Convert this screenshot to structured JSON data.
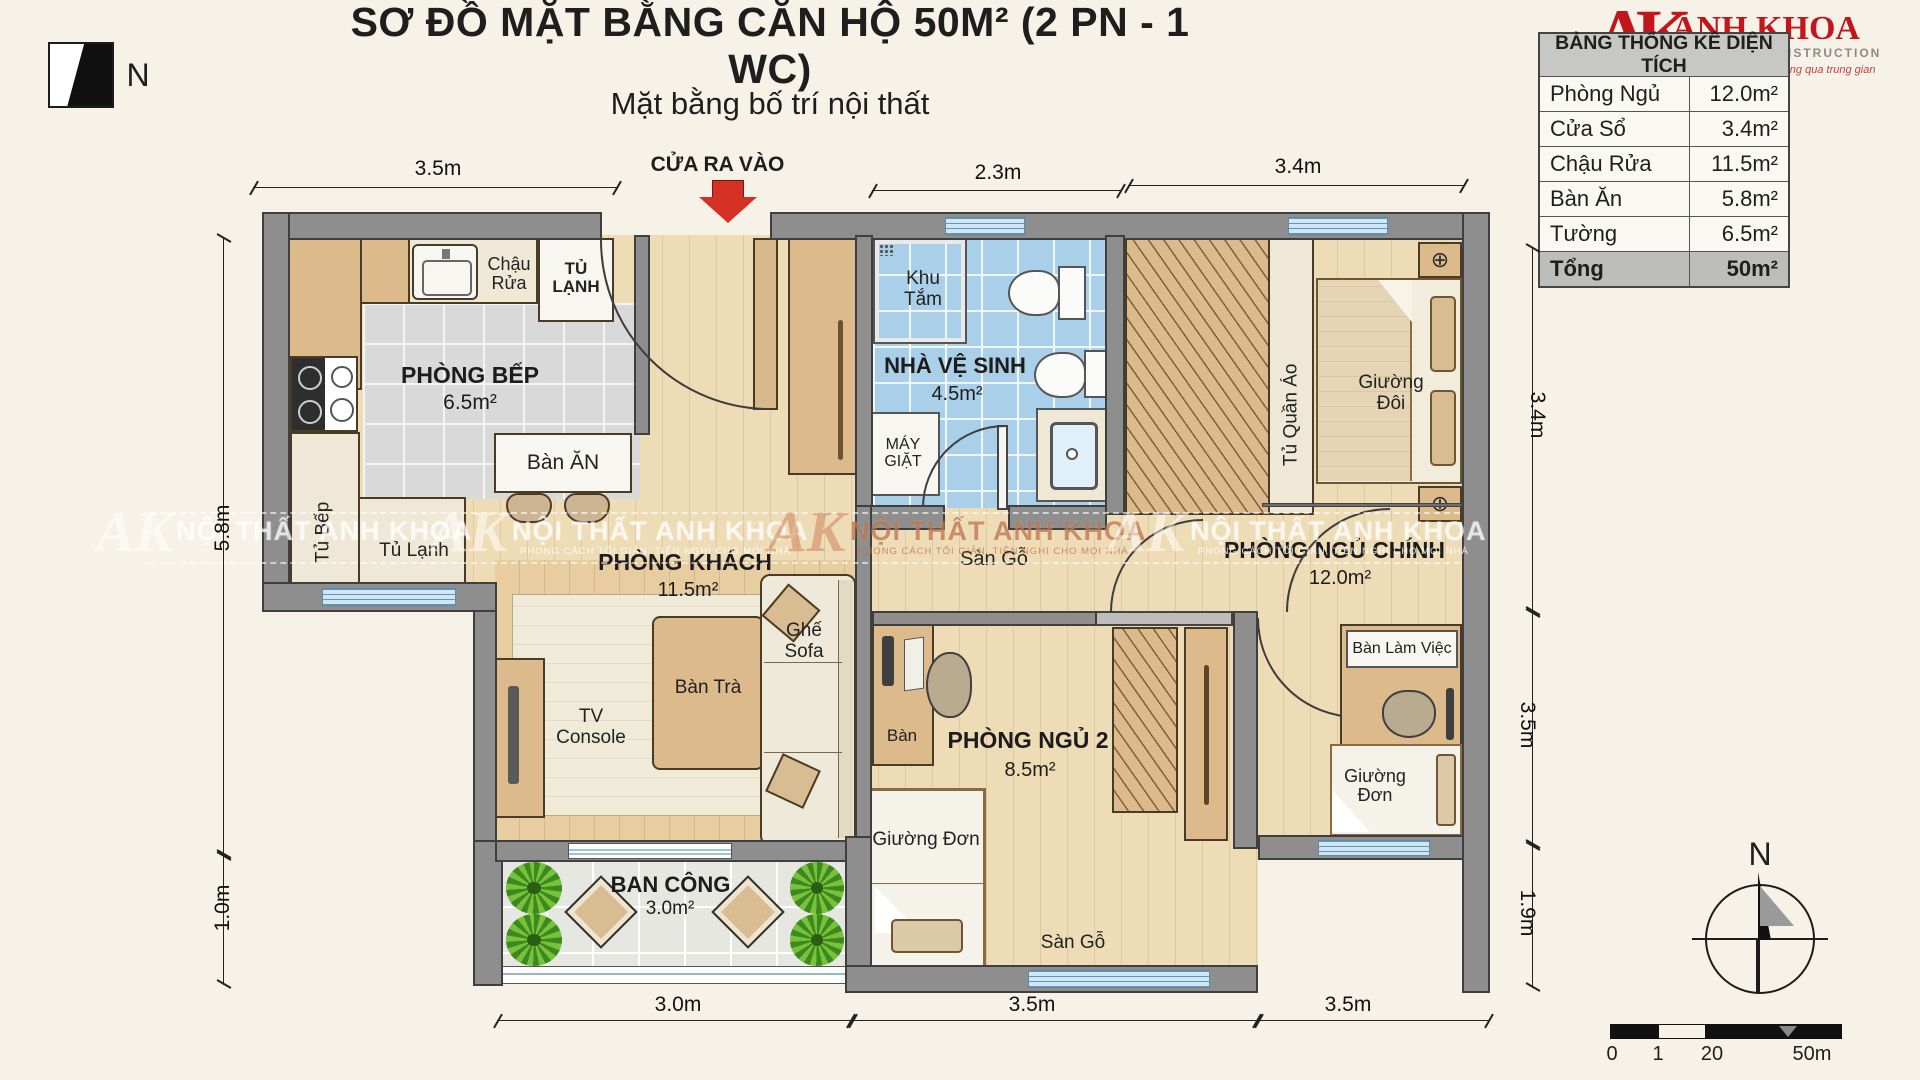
{
  "header": {
    "title": "SƠ ĐỒ MẶT BẰNG CĂN HỘ 50M² (2 PN - 1 WC)",
    "subtitle": "Mặt bằng bố trí nội thất",
    "entrance_label": "CỬA RA VÀO"
  },
  "logo": {
    "monogram": "AK",
    "name": "ANH KHOA",
    "tagline1": "INTERIOR CONSTRUCTION",
    "tagline2": "Sản xuất trực tiếp - Không qua trung gian"
  },
  "area_table": {
    "header": "BẢNG THỐNG KÊ DIỆN TÍCH",
    "rows": [
      {
        "label": "Phòng Ngủ",
        "value": "12.0m²"
      },
      {
        "label": "Cửa Sổ",
        "value": "3.4m²"
      },
      {
        "label": "Chậu Rửa",
        "value": "11.5m²"
      },
      {
        "label": "Bàn Ăn",
        "value": "5.8m²"
      },
      {
        "label": "Tường",
        "value": "6.5m²"
      }
    ],
    "total": {
      "label": "Tổng",
      "value": "50m²"
    }
  },
  "compass": {
    "north": "N"
  },
  "dims": {
    "top": [
      "3.5m",
      "2.3m",
      "3.4m"
    ],
    "left": [
      "5.8m",
      "1.0m"
    ],
    "right": [
      "3.4m",
      "3.5m",
      "1.9m"
    ],
    "bottom": [
      "3.0m",
      "3.5m",
      "3.5m"
    ]
  },
  "rooms": {
    "kitchen": {
      "name": "PHÒNG BẾP",
      "area": "6.5m²"
    },
    "living": {
      "name": "PHÒNG KHÁCH",
      "area": "11.5m²"
    },
    "bathroom": {
      "name": "NHÀ VỆ SINH",
      "area": "4.5m²"
    },
    "master": {
      "name": "PHÒNG NGỦ CHÍNH",
      "area": "12.0m²"
    },
    "bedroom2": {
      "name": "PHÒNG NGỦ 2",
      "area": "8.5m²"
    },
    "balcony": {
      "name": "BAN CÔNG",
      "area": "3.0m²"
    }
  },
  "furniture": {
    "sink": "Chậu Rửa",
    "fridge": "TỦ LẠNH",
    "dining_table": "Bàn ĂN",
    "kitchen_cabinet": "Tủ Bếp",
    "fridge2": "Tủ Lạnh",
    "shower": "Khu Tắm",
    "washer": "MÁY GIẶT",
    "tv_console": "TV Console",
    "tea_table": "Bàn Trà",
    "sofa": "Ghế Sofa",
    "wardrobe": "Tủ Quần Áo",
    "double_bed": "Giường Đôi",
    "desk_master": "Bàn Làm Việc",
    "single_bed_right": "Giường Đơn",
    "single_bed_2": "Giường Đơn",
    "desk2": "Bàn",
    "wood_floor_hall": "Sàn Gỗ",
    "wood_floor_bottom": "Sàn Gỗ"
  },
  "watermark": {
    "text": "NỘI THẤT ANH KHOA",
    "tagline": "PHONG CÁCH TỐI GIẢN, TIỆN NGHI CHO MỌI NHÀ",
    "monogram": "AK"
  },
  "scalebar": {
    "labels": [
      "0",
      "1",
      "20",
      "50m"
    ]
  }
}
